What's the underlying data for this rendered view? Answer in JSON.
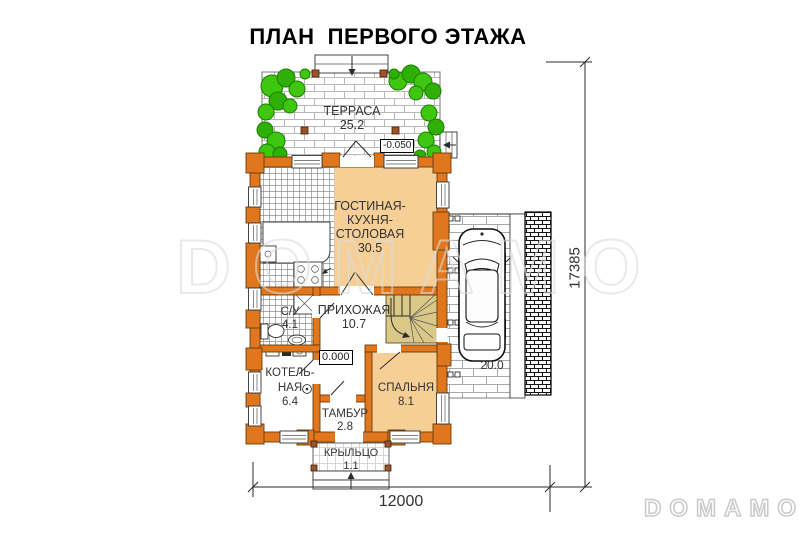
{
  "title": "ПЛАН  ПЕРВОГО ЭТАЖА",
  "watermark_text": "DOMAMO",
  "brand_logo": "DOMAMO",
  "rooms": {
    "terrace": {
      "name": "ТЕРРАСА",
      "area": "25.2"
    },
    "living": {
      "line1": "ГОСТИНАЯ-",
      "line2": "КУХНЯ-",
      "line3": "СТОЛОВАЯ",
      "area": "30.5"
    },
    "hallway": {
      "name": "ПРИХОЖАЯ",
      "area": "10.7"
    },
    "bathroom": {
      "name": "С/У",
      "area": "4.1"
    },
    "boiler": {
      "line1": "КОТЕЛЬ-",
      "line2": "НАЯ",
      "area": "6.4"
    },
    "vestibule": {
      "name": "ТАМБУР",
      "area": "2.8"
    },
    "bedroom": {
      "name": "СПАЛЬНЯ",
      "area": "8.1"
    },
    "porch": {
      "name": "КРЫЛЬЦО",
      "area": "1.1"
    },
    "carport": {
      "area": "20.0"
    }
  },
  "elevation_marks": {
    "terrace": "-0.050",
    "ground_floor": "0.000"
  },
  "dimensions": {
    "overall_width": "12000",
    "overall_height": "17385"
  },
  "colors": {
    "wall-orange": "#e0771f",
    "wall-outline": "#6b3a06",
    "room-tan": "#f5cf96",
    "stair-tan": "#d9c887",
    "bush-green": "#3ec70e",
    "bush-dark": "#1f7d00",
    "post-brown": "#a0522d"
  }
}
